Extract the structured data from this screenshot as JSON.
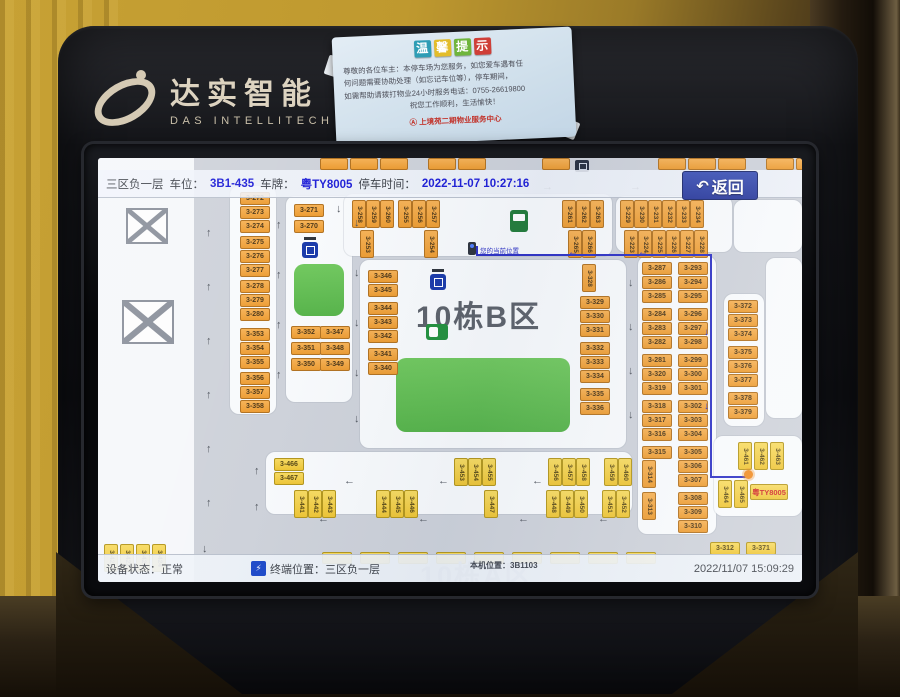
{
  "colors": {
    "spot_orange": "#ec9a2e",
    "spot_yellow": "#eec431",
    "route_blue": "#2a2ec4",
    "island_green": "#5cb84e",
    "value_blue": "#1b1bd6",
    "button_blue": "#27379b"
  },
  "kiosk": {
    "brand_cn": "达实智能",
    "brand_en": "DAS INTELLITECH"
  },
  "sticker": {
    "title": [
      "温",
      "馨",
      "提",
      "示"
    ],
    "title_colors": [
      "#2e9db5",
      "#e3bd2a",
      "#6fb53c",
      "#cf3f38"
    ],
    "lines": [
      "尊敬的各位车主：本停车场为您服务，如您爱车遇有任",
      "何问题需要协助处理（如忘记车位等），停车期间，",
      "如需帮助请拨打物业24小时服务电话：0755-26619800",
      "祝您工作顺利，生活愉快！"
    ],
    "seal": "Ⓐ 上境苑二期物业服务中心"
  },
  "screen": {
    "header": {
      "zone": "三区负一层",
      "spot_label": "车位：",
      "spot_value": "3B1-435",
      "plate_label": "车牌：",
      "plate_value": "粤TY8005",
      "time_label": "停车时间：",
      "time_value": "2022-11-07 10:27:16",
      "back": "返回",
      "back_icon": "↶"
    },
    "map": {
      "zone_title": "10栋B区",
      "zone_title_bottom": "10栋A区",
      "marker_label": "您的当前位置",
      "dest_plate": "粤TY8005",
      "islands": [
        [
          132,
          28,
          46,
          228
        ],
        [
          188,
          38,
          66,
          206
        ],
        [
          246,
          36,
          268,
          62
        ],
        [
          518,
          38,
          116,
          56
        ],
        [
          262,
          102,
          266,
          188
        ],
        [
          540,
          98,
          78,
          278
        ],
        [
          626,
          136,
          40,
          132
        ],
        [
          168,
          294,
          366,
          62
        ],
        [
          616,
          278,
          88,
          80
        ],
        [
          636,
          42,
          68,
          52
        ],
        [
          668,
          100,
          36,
          160
        ]
      ],
      "greens": [
        [
          298,
          200,
          174,
          74
        ],
        [
          196,
          106,
          50,
          52
        ]
      ],
      "spots_h": [
        [
          142,
          34,
          "3-272"
        ],
        [
          142,
          48,
          "3-273"
        ],
        [
          142,
          62,
          "3-274"
        ],
        [
          142,
          78,
          "3-275"
        ],
        [
          142,
          92,
          "3-276"
        ],
        [
          142,
          106,
          "3-277"
        ],
        [
          142,
          122,
          "3-278"
        ],
        [
          142,
          136,
          "3-279"
        ],
        [
          142,
          150,
          "3-280"
        ],
        [
          142,
          170,
          "3-353"
        ],
        [
          142,
          184,
          "3-354"
        ],
        [
          142,
          198,
          "3-355"
        ],
        [
          142,
          214,
          "3-356"
        ],
        [
          142,
          228,
          "3-357"
        ],
        [
          142,
          242,
          "3-358"
        ],
        [
          196,
          46,
          "3-271"
        ],
        [
          196,
          62,
          "3-270"
        ],
        [
          193,
          168,
          "3-352"
        ],
        [
          222,
          168,
          "3-347"
        ],
        [
          193,
          184,
          "3-351"
        ],
        [
          222,
          184,
          "3-348"
        ],
        [
          193,
          200,
          "3-350"
        ],
        [
          222,
          200,
          "3-349"
        ],
        [
          270,
          112,
          "3-346"
        ],
        [
          270,
          126,
          "3-345"
        ],
        [
          270,
          144,
          "3-344"
        ],
        [
          270,
          158,
          "3-343"
        ],
        [
          270,
          172,
          "3-342"
        ],
        [
          270,
          190,
          "3-341"
        ],
        [
          270,
          204,
          "3-340"
        ],
        [
          482,
          138,
          "3-329"
        ],
        [
          482,
          152,
          "3-330"
        ],
        [
          482,
          166,
          "3-331"
        ],
        [
          482,
          184,
          "3-332"
        ],
        [
          482,
          198,
          "3-333"
        ],
        [
          482,
          212,
          "3-334"
        ],
        [
          482,
          230,
          "3-335"
        ],
        [
          482,
          244,
          "3-336"
        ],
        [
          544,
          104,
          "3-287"
        ],
        [
          580,
          104,
          "3-293"
        ],
        [
          544,
          118,
          "3-286"
        ],
        [
          580,
          118,
          "3-294"
        ],
        [
          544,
          132,
          "3-285"
        ],
        [
          580,
          132,
          "3-295"
        ],
        [
          544,
          150,
          "3-284"
        ],
        [
          580,
          150,
          "3-296"
        ],
        [
          544,
          164,
          "3-283"
        ],
        [
          580,
          164,
          "3-297"
        ],
        [
          544,
          178,
          "3-282"
        ],
        [
          580,
          178,
          "3-298"
        ],
        [
          544,
          196,
          "3-281"
        ],
        [
          580,
          196,
          "3-299"
        ],
        [
          544,
          210,
          "3-320"
        ],
        [
          580,
          210,
          "3-300"
        ],
        [
          544,
          224,
          "3-319"
        ],
        [
          580,
          224,
          "3-301"
        ],
        [
          544,
          242,
          "3-318"
        ],
        [
          580,
          242,
          "3-302"
        ],
        [
          544,
          256,
          "3-317"
        ],
        [
          580,
          256,
          "3-303"
        ],
        [
          544,
          270,
          "3-316"
        ],
        [
          580,
          270,
          "3-304"
        ],
        [
          544,
          288,
          "3-315"
        ],
        [
          580,
          288,
          "3-305"
        ],
        [
          580,
          302,
          "3-306"
        ],
        [
          580,
          316,
          "3-307"
        ],
        [
          580,
          334,
          "3-308"
        ],
        [
          580,
          348,
          "3-309"
        ],
        [
          580,
          362,
          "3-310"
        ],
        [
          630,
          142,
          "3-372"
        ],
        [
          630,
          156,
          "3-373"
        ],
        [
          630,
          170,
          "3-374"
        ],
        [
          630,
          188,
          "3-375"
        ],
        [
          630,
          202,
          "3-376"
        ],
        [
          630,
          216,
          "3-377"
        ],
        [
          630,
          234,
          "3-378"
        ],
        [
          630,
          248,
          "3-379"
        ],
        [
          612,
          384,
          "3-312",
          "y"
        ],
        [
          648,
          384,
          "3-371",
          "y"
        ],
        [
          176,
          300,
          "3-466",
          "y"
        ],
        [
          176,
          314,
          "3-467",
          "y"
        ]
      ],
      "spots_v": [
        [
          254,
          42,
          "3-258"
        ],
        [
          268,
          42,
          "3-259"
        ],
        [
          282,
          42,
          "3-260"
        ],
        [
          300,
          42,
          "3-255"
        ],
        [
          314,
          42,
          "3-256"
        ],
        [
          328,
          42,
          "3-257"
        ],
        [
          262,
          72,
          "3-253"
        ],
        [
          326,
          72,
          "3-254"
        ],
        [
          464,
          42,
          "3-261"
        ],
        [
          478,
          42,
          "3-262"
        ],
        [
          492,
          42,
          "3-263"
        ],
        [
          470,
          72,
          "3-265"
        ],
        [
          484,
          72,
          "3-266"
        ],
        [
          522,
          42,
          "3-229"
        ],
        [
          536,
          42,
          "3-230"
        ],
        [
          550,
          42,
          "3-231"
        ],
        [
          564,
          42,
          "3-232"
        ],
        [
          578,
          42,
          "3-233"
        ],
        [
          592,
          42,
          "3-234"
        ],
        [
          526,
          72,
          "3-223"
        ],
        [
          540,
          72,
          "3-224"
        ],
        [
          554,
          72,
          "3-225"
        ],
        [
          568,
          72,
          "3-226"
        ],
        [
          582,
          72,
          "3-227"
        ],
        [
          596,
          72,
          "3-228"
        ],
        [
          484,
          106,
          "3-328"
        ],
        [
          544,
          302,
          "3-314"
        ],
        [
          544,
          334,
          "3-313"
        ],
        [
          356,
          300,
          "3-453",
          "y"
        ],
        [
          370,
          300,
          "3-454",
          "y"
        ],
        [
          384,
          300,
          "3-455",
          "y"
        ],
        [
          450,
          300,
          "3-456",
          "y"
        ],
        [
          464,
          300,
          "3-457",
          "y"
        ],
        [
          478,
          300,
          "3-458",
          "y"
        ],
        [
          506,
          300,
          "3-459",
          "y"
        ],
        [
          520,
          300,
          "3-460",
          "y"
        ],
        [
          196,
          332,
          "3-441",
          "y"
        ],
        [
          210,
          332,
          "3-442",
          "y"
        ],
        [
          224,
          332,
          "3-443",
          "y"
        ],
        [
          278,
          332,
          "3-444",
          "y"
        ],
        [
          292,
          332,
          "3-445",
          "y"
        ],
        [
          306,
          332,
          "3-446",
          "y"
        ],
        [
          386,
          332,
          "3-447",
          "y"
        ],
        [
          448,
          332,
          "3-448",
          "y"
        ],
        [
          462,
          332,
          "3-449",
          "y"
        ],
        [
          476,
          332,
          "3-450",
          "y"
        ],
        [
          504,
          332,
          "3-451",
          "y"
        ],
        [
          518,
          332,
          "3-452",
          "y"
        ],
        [
          640,
          284,
          "3-461",
          "y"
        ],
        [
          656,
          284,
          "3-462",
          "y"
        ],
        [
          672,
          284,
          "3-463",
          "y"
        ],
        [
          620,
          322,
          "3-464",
          "y"
        ],
        [
          636,
          322,
          "3-465",
          "y"
        ],
        [
          6,
          386,
          "3-421",
          "y"
        ],
        [
          22,
          386,
          "3-422",
          "y"
        ],
        [
          38,
          386,
          "3-423",
          "y"
        ],
        [
          54,
          386,
          "3-424",
          "y"
        ]
      ],
      "top_cut_spots": [
        222,
        252,
        282,
        330,
        360,
        444,
        560,
        590,
        620,
        668,
        698
      ],
      "bottom_cut_spots": [
        224,
        262,
        300,
        338,
        376,
        414,
        452,
        490,
        528
      ],
      "arrows": [
        [
          180,
          24,
          "r"
        ],
        [
          268,
          24,
          "r"
        ],
        [
          356,
          24,
          "r"
        ],
        [
          444,
          24,
          "r"
        ],
        [
          532,
          24,
          "r"
        ],
        [
          624,
          24,
          "r"
        ],
        [
          108,
          70,
          "u"
        ],
        [
          108,
          124,
          "u"
        ],
        [
          108,
          178,
          "u"
        ],
        [
          108,
          232,
          "u"
        ],
        [
          108,
          286,
          "u"
        ],
        [
          108,
          340,
          "u"
        ],
        [
          178,
          62,
          "u"
        ],
        [
          178,
          112,
          "u"
        ],
        [
          178,
          162,
          "u"
        ],
        [
          178,
          212,
          "u"
        ],
        [
          256,
          60,
          "d"
        ],
        [
          256,
          110,
          "d"
        ],
        [
          256,
          160,
          "d"
        ],
        [
          256,
          210,
          "d"
        ],
        [
          256,
          256,
          "d"
        ],
        [
          530,
          120,
          "d"
        ],
        [
          530,
          164,
          "d"
        ],
        [
          530,
          208,
          "d"
        ],
        [
          530,
          252,
          "d"
        ],
        [
          238,
          46,
          "d"
        ],
        [
          220,
          356,
          "l"
        ],
        [
          320,
          356,
          "l"
        ],
        [
          420,
          356,
          "l"
        ],
        [
          500,
          356,
          "l"
        ],
        [
          246,
          318,
          "l"
        ],
        [
          340,
          318,
          "l"
        ],
        [
          434,
          318,
          "l"
        ],
        [
          156,
          308,
          "u"
        ],
        [
          156,
          344,
          "u"
        ],
        [
          104,
          386,
          "d"
        ]
      ],
      "route": {
        "pts": [
          [
            378,
            88
          ],
          [
            378,
            96
          ],
          [
            612,
            96
          ],
          [
            612,
            318
          ],
          [
            650,
            318
          ]
        ],
        "arrows": [
          [
            470,
            90,
            "l"
          ],
          [
            540,
            90,
            "l"
          ],
          [
            606,
            170,
            "d"
          ],
          [
            606,
            244,
            "d"
          ]
        ],
        "dot": [
          646,
          312
        ]
      },
      "elevators": [
        [
          204,
          84
        ],
        [
          332,
          116
        ]
      ],
      "chargers": [
        [
          328,
          166
        ]
      ],
      "machines": [
        [
          412,
          52
        ]
      ],
      "marker": [
        370,
        84
      ],
      "dest_spot": [
        652,
        326
      ],
      "broken": [
        [
          28,
          50,
          38,
          32
        ],
        [
          24,
          142,
          48,
          40
        ]
      ]
    },
    "statusbar": {
      "device": "设备状态：正常",
      "terminal": "终端位置：三区负一层",
      "machine_code": "本机位置：3B1103",
      "datetime": "2022/11/07 15:09:29",
      "icon": "⚡"
    }
  }
}
